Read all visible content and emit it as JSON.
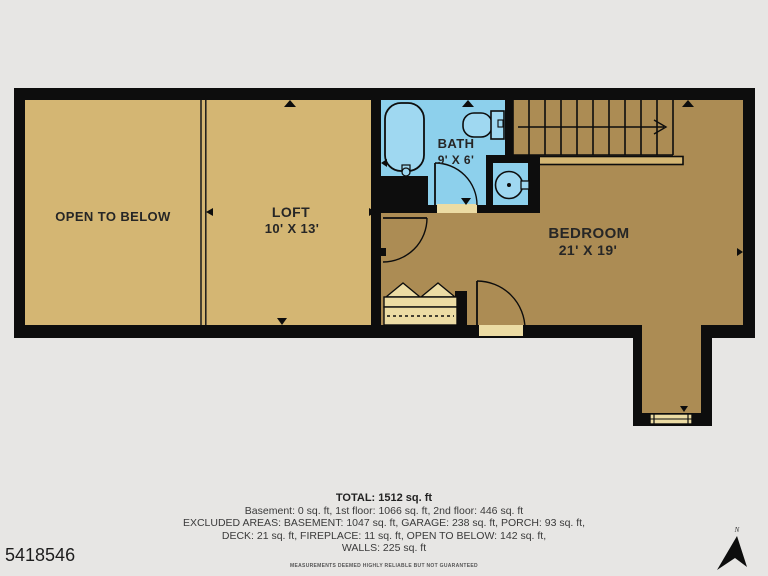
{
  "listing_id": "5418546",
  "rooms": {
    "open_to_below": {
      "name": "OPEN TO BELOW"
    },
    "loft": {
      "name": "LOFT",
      "dims": "10' X 13'"
    },
    "bath": {
      "name": "BATH",
      "dims": "9' X 6'"
    },
    "bedroom": {
      "name": "BEDROOM",
      "dims": "21' X 19'"
    }
  },
  "summary": {
    "total": "TOTAL: 1512 sq. ft",
    "floors": "Basement: 0 sq. ft, 1st floor: 1066 sq. ft, 2nd floor: 446 sq. ft",
    "excluded1": "EXCLUDED AREAS: BASEMENT: 1047 sq. ft, GARAGE: 238 sq. ft, PORCH: 93 sq. ft,",
    "excluded2": "DECK: 21 sq. ft, FIREPLACE: 11 sq. ft, OPEN TO BELOW: 142 sq. ft,",
    "walls": "WALLS: 225 sq. ft",
    "disclaimer": "MEASUREMENTS DEEMED HIGHLY RELIABLE BUT NOT GUARANTEED"
  },
  "compass": {
    "north_label": "N"
  },
  "colors": {
    "wall": "#0d0d0d",
    "loft_floor": "#d4b673",
    "bedroom_floor": "#ac8c54",
    "bath_floor": "#8dd0ec",
    "fixture_fill": "#9fd8f1",
    "closet_fill": "#ecdca4",
    "background": "#e7e6e4"
  }
}
